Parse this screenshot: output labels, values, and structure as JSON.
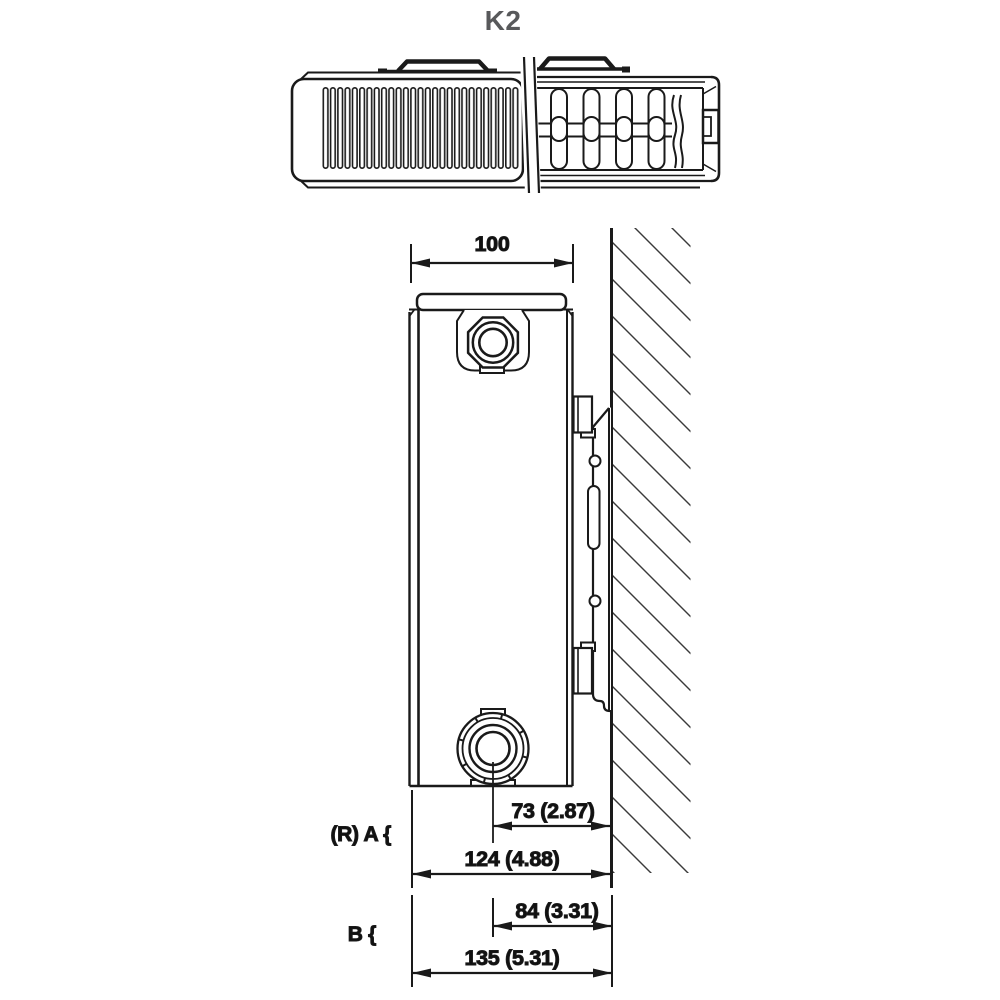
{
  "title": "K2",
  "colors": {
    "line": "#1a1a1a",
    "title": "#58595b",
    "hatch": "#3a3a3a"
  },
  "dimensions": {
    "depth": {
      "value": "100"
    },
    "group_a": {
      "label": "(R) A {",
      "pipe_to_wall": "73 (2.87)",
      "front_to_wall": "124 (4.88)"
    },
    "group_b": {
      "label": "B {",
      "pipe_to_wall": "84 (3.31)",
      "front_to_wall": "135 (5.31)"
    }
  }
}
